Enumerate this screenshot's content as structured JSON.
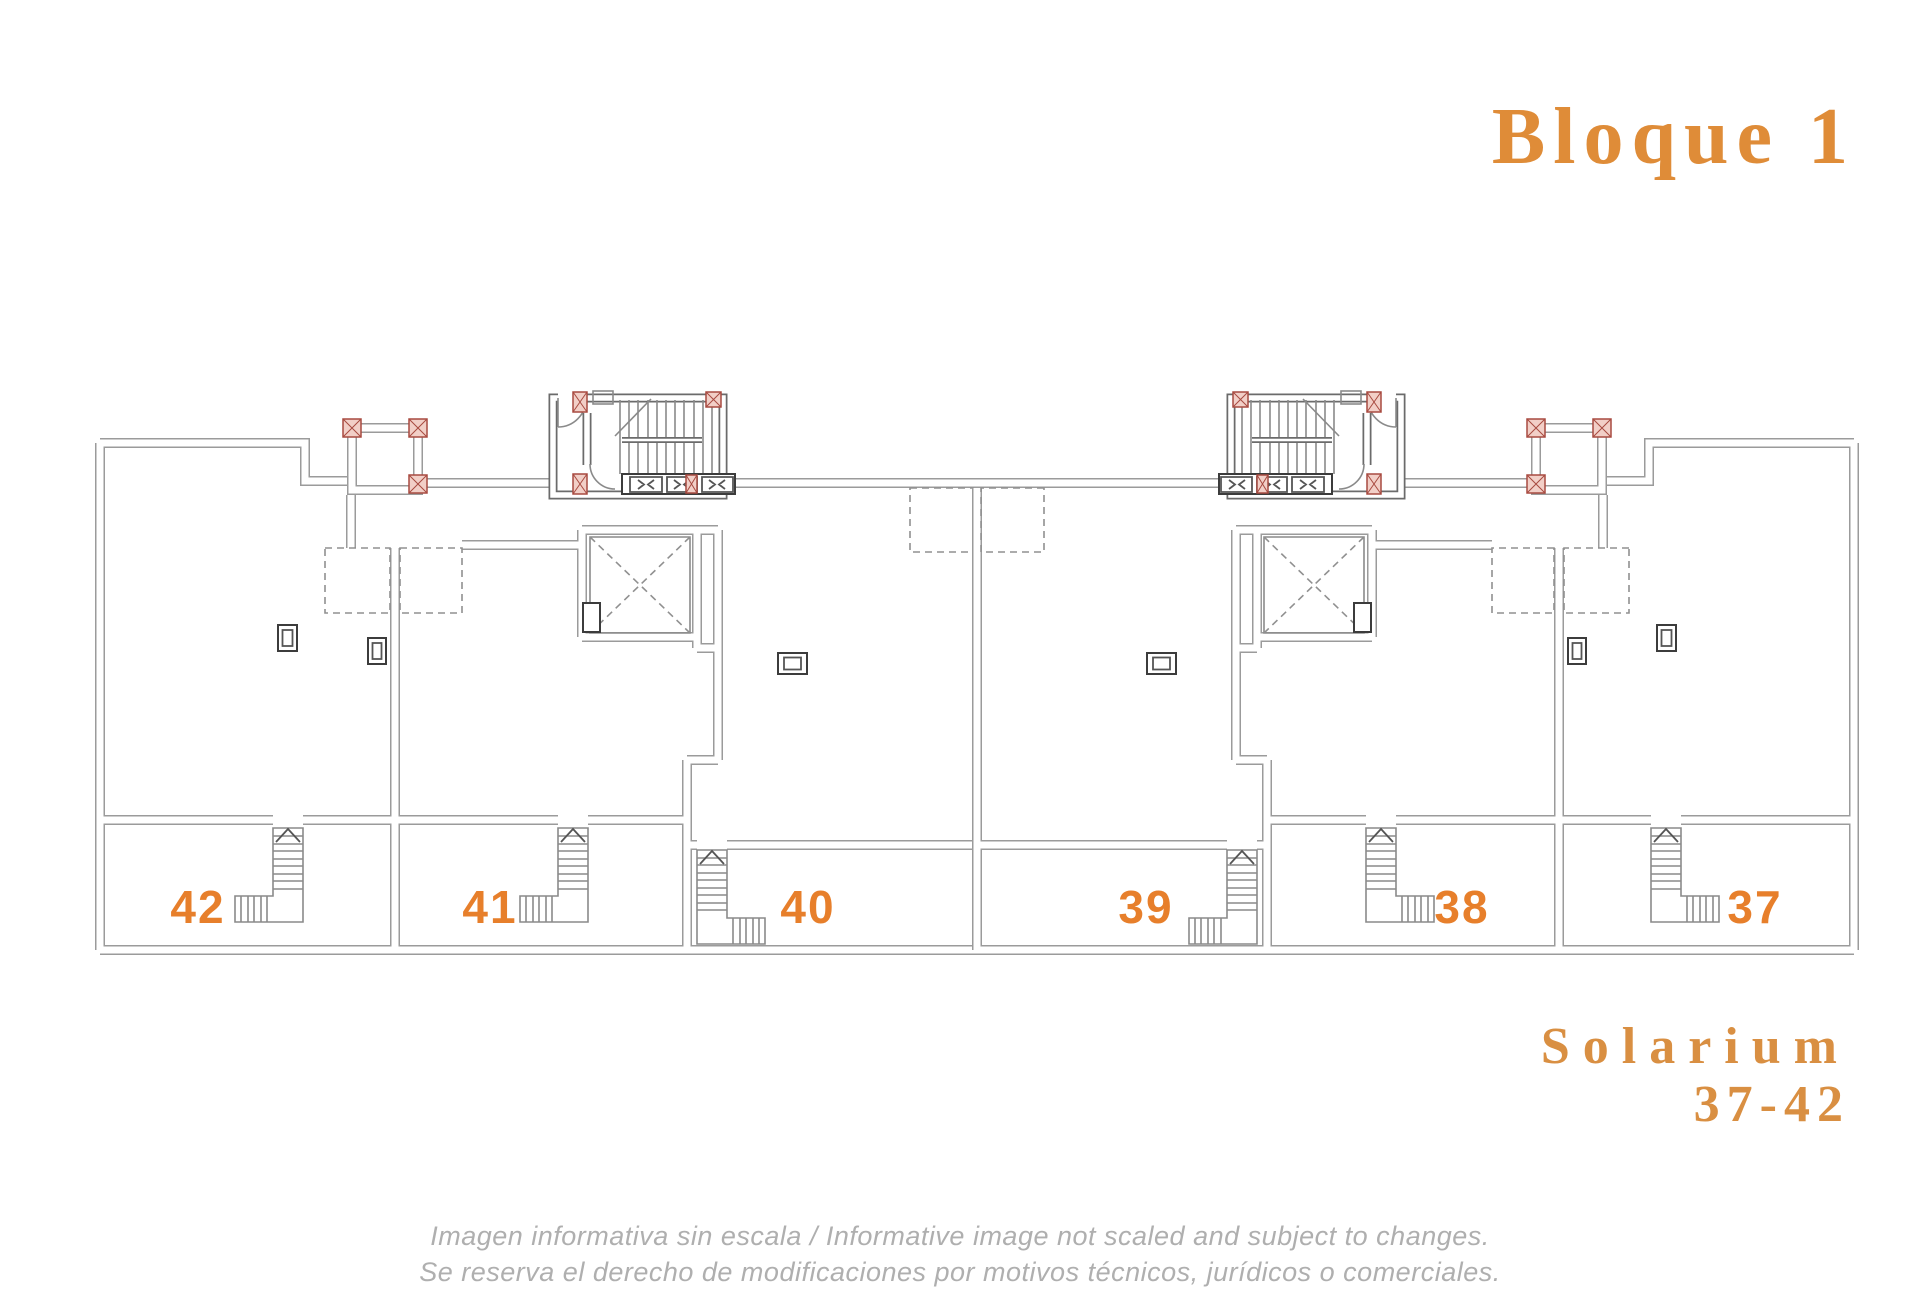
{
  "header": {
    "block_title": "Bloque 1"
  },
  "plan": {
    "units": [
      {
        "number": "42"
      },
      {
        "number": "41"
      },
      {
        "number": "40"
      },
      {
        "number": "39"
      },
      {
        "number": "38"
      },
      {
        "number": "37"
      }
    ]
  },
  "footer": {
    "plan_type": "Solarium",
    "unit_range": "37-42",
    "disclaimer_line1": "Imagen informativa sin escala /  Informative image not scaled and subject to changes.",
    "disclaimer_line2": "Se reserva el derecho de modificaciones por motivos técnicos, jurídicos o comerciales."
  },
  "colors": {
    "accent_number_orange": "#E77F2B",
    "title_orange": "#DF8C38",
    "wall_gray": "#9B9B9B",
    "core_gray": "#6B6B6B",
    "column_red": "#A84A40",
    "column_fill": "#F2CFC7",
    "disclaimer_gray": "#AFAFAF",
    "background": "#FFFFFF"
  }
}
